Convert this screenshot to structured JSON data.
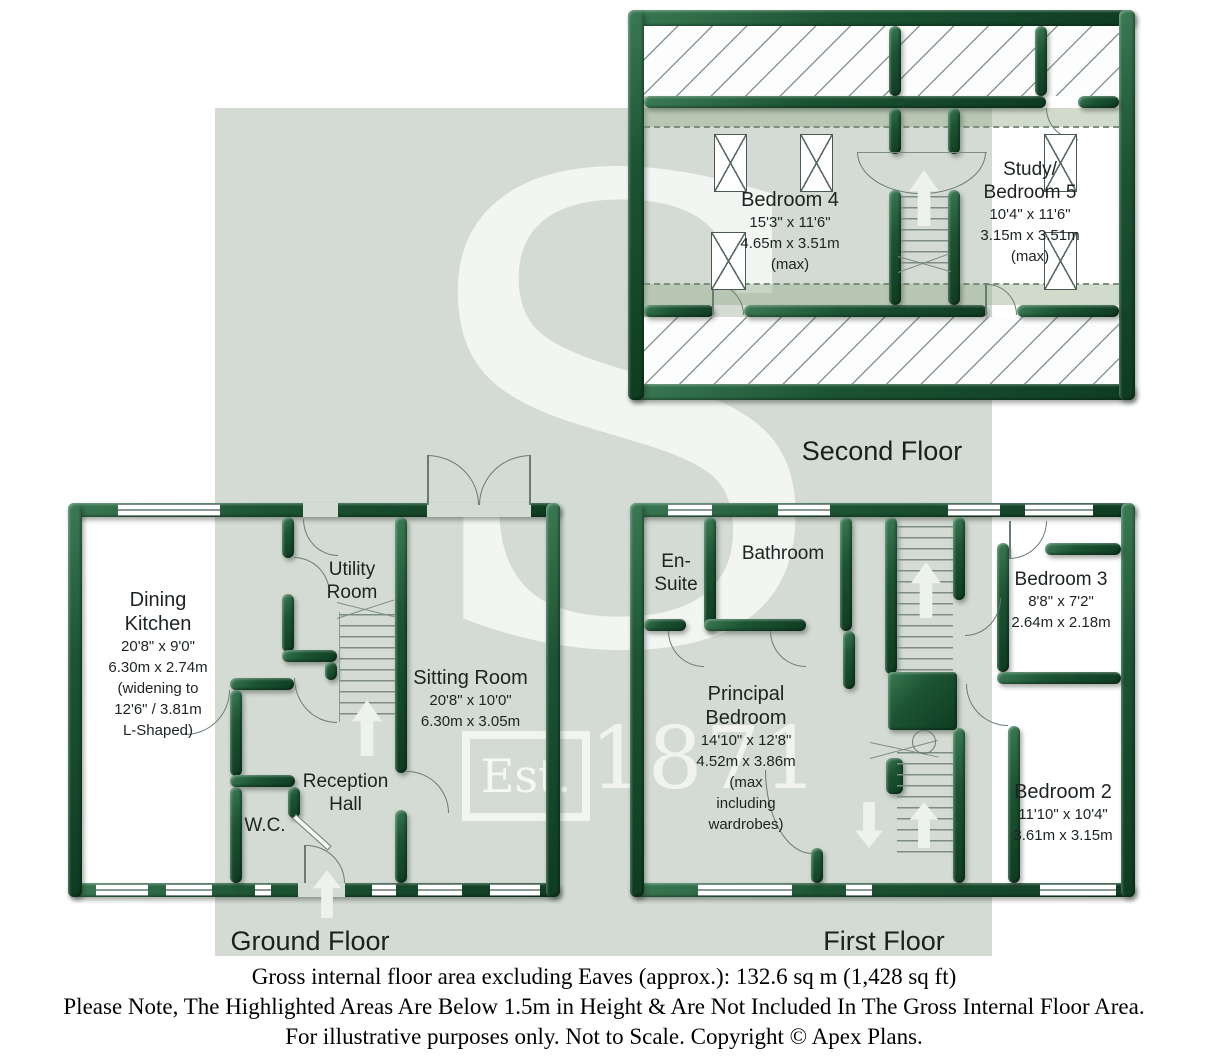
{
  "watermark": {
    "letter": "S",
    "est": "Est.",
    "year": "1871"
  },
  "floors": {
    "second_floor": {
      "title": "Second Floor",
      "bedroom4": {
        "name": "Bedroom 4",
        "dims": [
          "15'3\" x 11'6\"",
          "4.65m x 3.51m",
          "(max)"
        ]
      },
      "bedroom5": {
        "name1": "Study/",
        "name2": "Bedroom 5",
        "dims": [
          "10'4\" x 11'6\"",
          "3.15m x 3.51m",
          "(max)"
        ]
      }
    },
    "ground_floor": {
      "title": "Ground Floor",
      "dining_kitchen": {
        "name1": "Dining",
        "name2": "Kitchen",
        "dims": [
          "20'8\" x 9'0\"",
          "6.30m x 2.74m",
          "(widening to",
          "12'6\" / 3.81m",
          "L-Shaped)"
        ]
      },
      "utility": {
        "name1": "Utility",
        "name2": "Room"
      },
      "sitting": {
        "name": "Sitting Room",
        "dims": [
          "20'8\" x 10'0\"",
          "6.30m x 3.05m"
        ]
      },
      "reception": {
        "name1": "Reception",
        "name2": "Hall"
      },
      "wc": {
        "name": "W.C."
      }
    },
    "first_floor": {
      "title": "First Floor",
      "ensuite": {
        "name1": "En-",
        "name2": "Suite"
      },
      "bathroom": {
        "name": "Bathroom"
      },
      "principal": {
        "name1": "Principal",
        "name2": "Bedroom",
        "dims": [
          "14'10\" x 12'8\"",
          "4.52m x 3.86m",
          "(max",
          "including",
          "wardrobes)"
        ]
      },
      "bedroom3": {
        "name": "Bedroom 3",
        "dims": [
          "8'8\" x 7'2\"",
          "2.64m x 2.18m"
        ]
      },
      "bedroom2": {
        "name": "Bedroom 2",
        "dims": [
          "11'10\" x 10'4\"",
          "3.61m x 3.15m"
        ]
      }
    }
  },
  "notes": {
    "line1": "Gross internal floor area excluding Eaves (approx.): 132.6 sq m (1,428 sq ft)",
    "line2": "Please Note, The Highlighted Areas Are Below 1.5m in Height & Are Not Included In The Gross Internal Floor Area.",
    "line3": "For illustrative purposes only. Not to Scale. Copyright © Apex Plans."
  },
  "colors": {
    "wall_green": "#16492b",
    "panel_grey": "#d3dbd4",
    "eaves_tint": "rgba(150,175,140,0.45)"
  }
}
